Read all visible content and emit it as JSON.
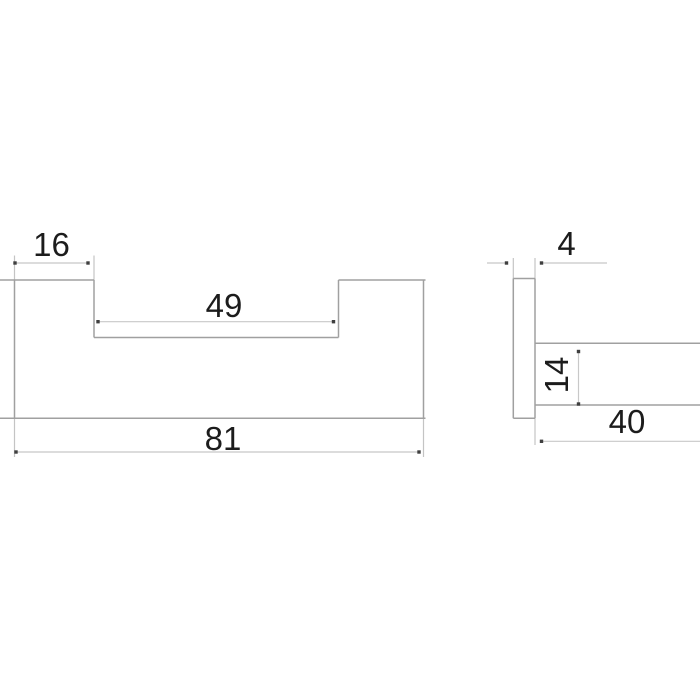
{
  "drawing": {
    "kind": "technical-dimension-drawing",
    "colors": {
      "background": "#ffffff",
      "outline": "#a0a0a0",
      "dimension_line": "#c8c8c8",
      "extension_line": "#c4c4c4",
      "marker": "#3f3f3f",
      "text": "#1c1c1c"
    },
    "views": [
      {
        "id": "front-view",
        "shape": "u-profile-handle",
        "dimensions": [
          {
            "label": "16",
            "value": 16,
            "orientation": "horizontal",
            "measures": "left-flange-width"
          },
          {
            "label": "49",
            "value": 49,
            "orientation": "horizontal",
            "measures": "inner-recess-width"
          },
          {
            "label": "81",
            "value": 81,
            "orientation": "horizontal",
            "measures": "overall-width"
          }
        ]
      },
      {
        "id": "side-view",
        "shape": "plate-with-arm",
        "dimensions": [
          {
            "label": "4",
            "value": 4,
            "orientation": "horizontal",
            "measures": "plate-thickness"
          },
          {
            "label": "14",
            "value": 14,
            "orientation": "vertical",
            "measures": "arm-height"
          },
          {
            "label": "40",
            "value": 40,
            "orientation": "horizontal",
            "measures": "arm-length"
          }
        ]
      }
    ],
    "geometry": {
      "outline_segments": [
        {
          "name": "front-top-left-edge",
          "x1": 0,
          "y1": 280,
          "x2": 94,
          "y2": 280
        },
        {
          "name": "front-left-edge",
          "x1": 14.5,
          "y1": 280,
          "x2": 14.5,
          "y2": 418.3
        },
        {
          "name": "front-recess-left-step",
          "x1": 94,
          "y1": 280,
          "x2": 94,
          "y2": 337.5
        },
        {
          "name": "front-recess-floor",
          "x1": 94,
          "y1": 337.5,
          "x2": 338.5,
          "y2": 337.5
        },
        {
          "name": "front-recess-right-step",
          "x1": 338.5,
          "y1": 280,
          "x2": 338.5,
          "y2": 337.5
        },
        {
          "name": "front-top-right-edge",
          "x1": 338.5,
          "y1": 280,
          "x2": 425.5,
          "y2": 280
        },
        {
          "name": "front-right-edge",
          "x1": 423.5,
          "y1": 280,
          "x2": 423.5,
          "y2": 418.3
        },
        {
          "name": "front-bottom-edge",
          "x1": 0,
          "y1": 418.3,
          "x2": 425.5,
          "y2": 418.3
        },
        {
          "name": "side-plate-left-edge",
          "x1": 513.3,
          "y1": 278.5,
          "x2": 513.3,
          "y2": 418.3
        },
        {
          "name": "side-plate-right-edge",
          "x1": 535,
          "y1": 278.5,
          "x2": 535,
          "y2": 418.3
        },
        {
          "name": "side-plate-top-edge",
          "x1": 513.3,
          "y1": 278.5,
          "x2": 535,
          "y2": 278.5
        },
        {
          "name": "side-plate-bottom-edge",
          "x1": 513.3,
          "y1": 418.3,
          "x2": 535,
          "y2": 418.3
        },
        {
          "name": "side-arm-top-edge",
          "x1": 535,
          "y1": 343.3,
          "x2": 700,
          "y2": 343.3
        },
        {
          "name": "side-arm-bottom-edge",
          "x1": 535,
          "y1": 405,
          "x2": 700,
          "y2": 405
        }
      ],
      "extension_segments": [
        {
          "name": "ext-front-left-up",
          "x1": 14.5,
          "y1": 255.5,
          "x2": 14.5,
          "y2": 280
        },
        {
          "name": "ext-front-step-up",
          "x1": 94,
          "y1": 255.5,
          "x2": 94,
          "y2": 280
        },
        {
          "name": "ext-front-left-down",
          "x1": 14.5,
          "y1": 418.3,
          "x2": 14.5,
          "y2": 457
        },
        {
          "name": "ext-front-right-down",
          "x1": 423.5,
          "y1": 418.3,
          "x2": 423.5,
          "y2": 457
        },
        {
          "name": "ext-side-plate-left-up",
          "x1": 513.3,
          "y1": 258,
          "x2": 513.3,
          "y2": 278.5
        },
        {
          "name": "ext-side-plate-right-up",
          "x1": 535,
          "y1": 258,
          "x2": 535,
          "y2": 278.5
        },
        {
          "name": "ext-side-plate-down",
          "x1": 535,
          "y1": 418.3,
          "x2": 535,
          "y2": 445
        }
      ],
      "dimension_lines": [
        {
          "name": "dim-line-16",
          "x1": 15,
          "y1": 263,
          "x2": 88,
          "y2": 263
        },
        {
          "name": "dim-line-49",
          "x1": 98,
          "y1": 321.7,
          "x2": 333.5,
          "y2": 321.7
        },
        {
          "name": "dim-line-81",
          "x1": 16,
          "y1": 452,
          "x2": 419,
          "y2": 452
        },
        {
          "name": "dim-leader-4-left",
          "x1": 487,
          "y1": 263,
          "x2": 506.5,
          "y2": 263
        },
        {
          "name": "dim-leader-4-right",
          "x1": 541.5,
          "y1": 263,
          "x2": 607,
          "y2": 263
        },
        {
          "name": "dim-line-14",
          "x1": 578.5,
          "y1": 351.5,
          "x2": 578.5,
          "y2": 404
        },
        {
          "name": "dim-line-40",
          "x1": 541.5,
          "y1": 441.3,
          "x2": 700,
          "y2": 441.3
        }
      ],
      "markers": [
        {
          "x": 15,
          "y": 263
        },
        {
          "x": 88,
          "y": 263
        },
        {
          "x": 98,
          "y": 321.7
        },
        {
          "x": 333.5,
          "y": 321.7
        },
        {
          "x": 16,
          "y": 452
        },
        {
          "x": 419,
          "y": 452
        },
        {
          "x": 506.5,
          "y": 263
        },
        {
          "x": 541.5,
          "y": 263
        },
        {
          "x": 578.5,
          "y": 351.5
        },
        {
          "x": 578.5,
          "y": 404
        },
        {
          "x": 541.5,
          "y": 441.3
        }
      ],
      "labels": [
        {
          "text": "16",
          "x": 51.5,
          "y": 256,
          "rotate": 0
        },
        {
          "text": "49",
          "x": 224,
          "y": 317,
          "rotate": 0
        },
        {
          "text": "81",
          "x": 223,
          "y": 450,
          "rotate": 0
        },
        {
          "text": "4",
          "x": 566.5,
          "y": 255,
          "rotate": 0
        },
        {
          "text": "14",
          "x": 568,
          "y": 375,
          "rotate": -90
        },
        {
          "text": "40",
          "x": 627,
          "y": 433,
          "rotate": 0
        }
      ]
    }
  }
}
